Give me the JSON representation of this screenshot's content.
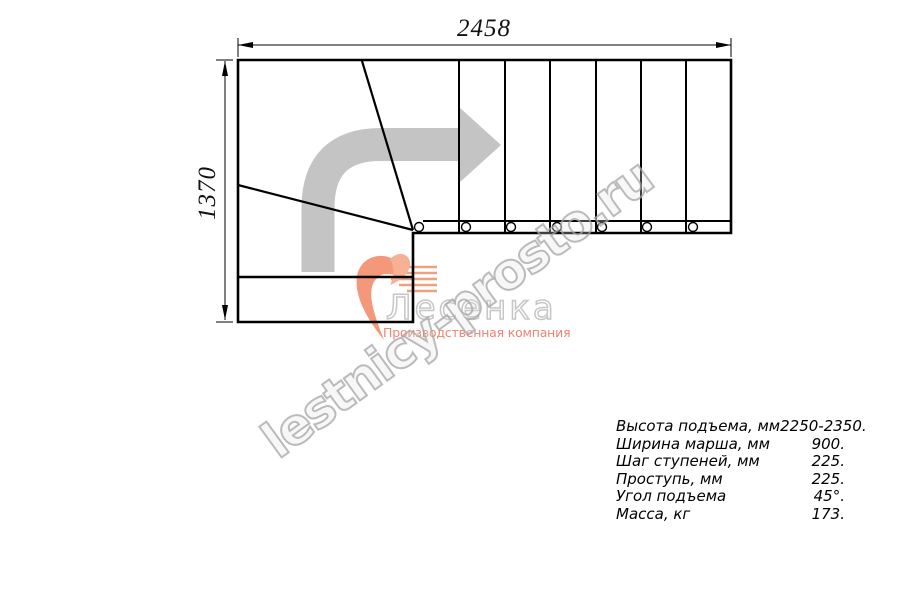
{
  "drawing": {
    "width_label": "2458",
    "height_label": "1370",
    "direction_arrow_icon": "curved-right-arrow",
    "treads_straight": 6,
    "baluster_count": 7
  },
  "watermark": {
    "text": "lestnicy-prosto.ru"
  },
  "logo": {
    "name": "Лесенка",
    "tagline": "Производственная компания",
    "accent_color": "#ee8372",
    "mark_icon": "heart-swoosh"
  },
  "specs": {
    "rows": [
      {
        "label": "Высота подъема, мм",
        "value": "2250-2350."
      },
      {
        "label": "Ширина марша, мм",
        "value": "900."
      },
      {
        "label": "Шаг ступеней, мм",
        "value": "225."
      },
      {
        "label": "Проступь, мм",
        "value": "225."
      },
      {
        "label": "Угол подъема",
        "value": "45°."
      },
      {
        "label": "Масса, кг",
        "value": "173."
      }
    ]
  },
  "colors": {
    "line": "#000000",
    "arrow_gray": "#c4c4c4",
    "watermark_gray": "#bdbdbd",
    "logo_outline_gray": "#c6c6c6",
    "logo_coral": "#f3987a"
  }
}
